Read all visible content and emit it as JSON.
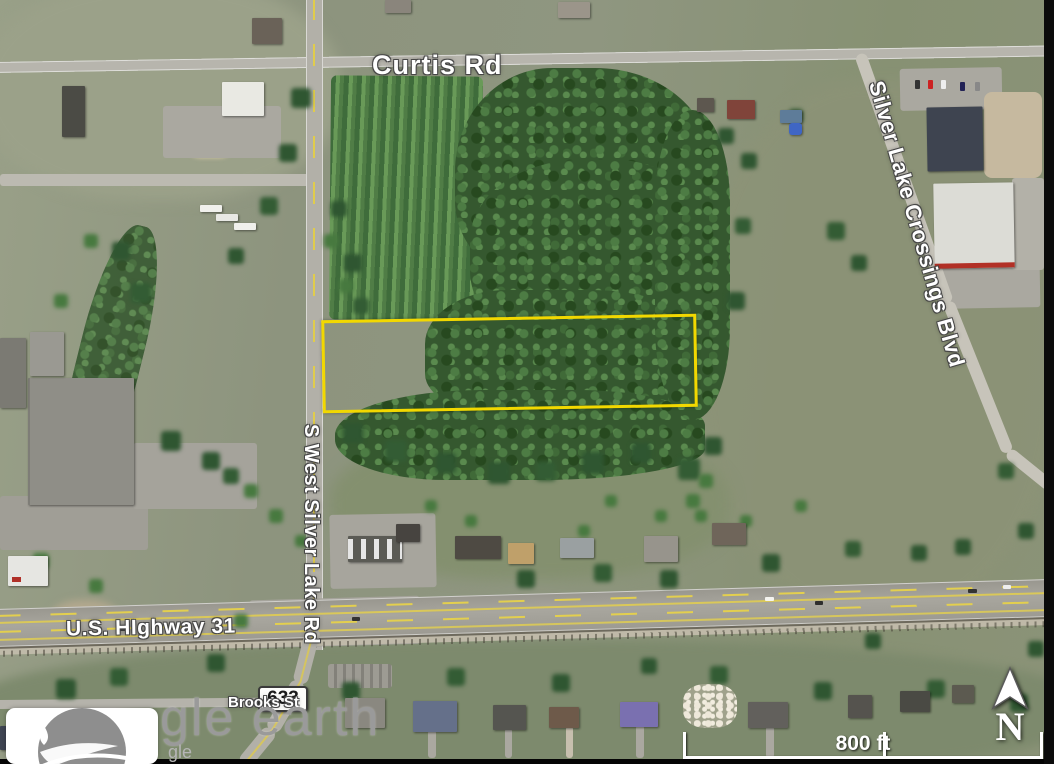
{
  "map": {
    "labels": {
      "curtis_rd": "Curtis Rd",
      "silver_lake_rd": "S West Silver Lake Rd",
      "crossings_blvd": "Silver Lake Crossings Blvd",
      "highway": "U.S. HIghway 31",
      "brooks_st": "Brooks St",
      "route_shield": "633"
    },
    "overlay": {
      "parcel_outline_color": "#f2d800"
    },
    "scale_bar": {
      "label": "800 ft"
    },
    "compass": {
      "label": "N"
    },
    "watermark": {
      "large": "gle earth",
      "small": "gle"
    }
  }
}
